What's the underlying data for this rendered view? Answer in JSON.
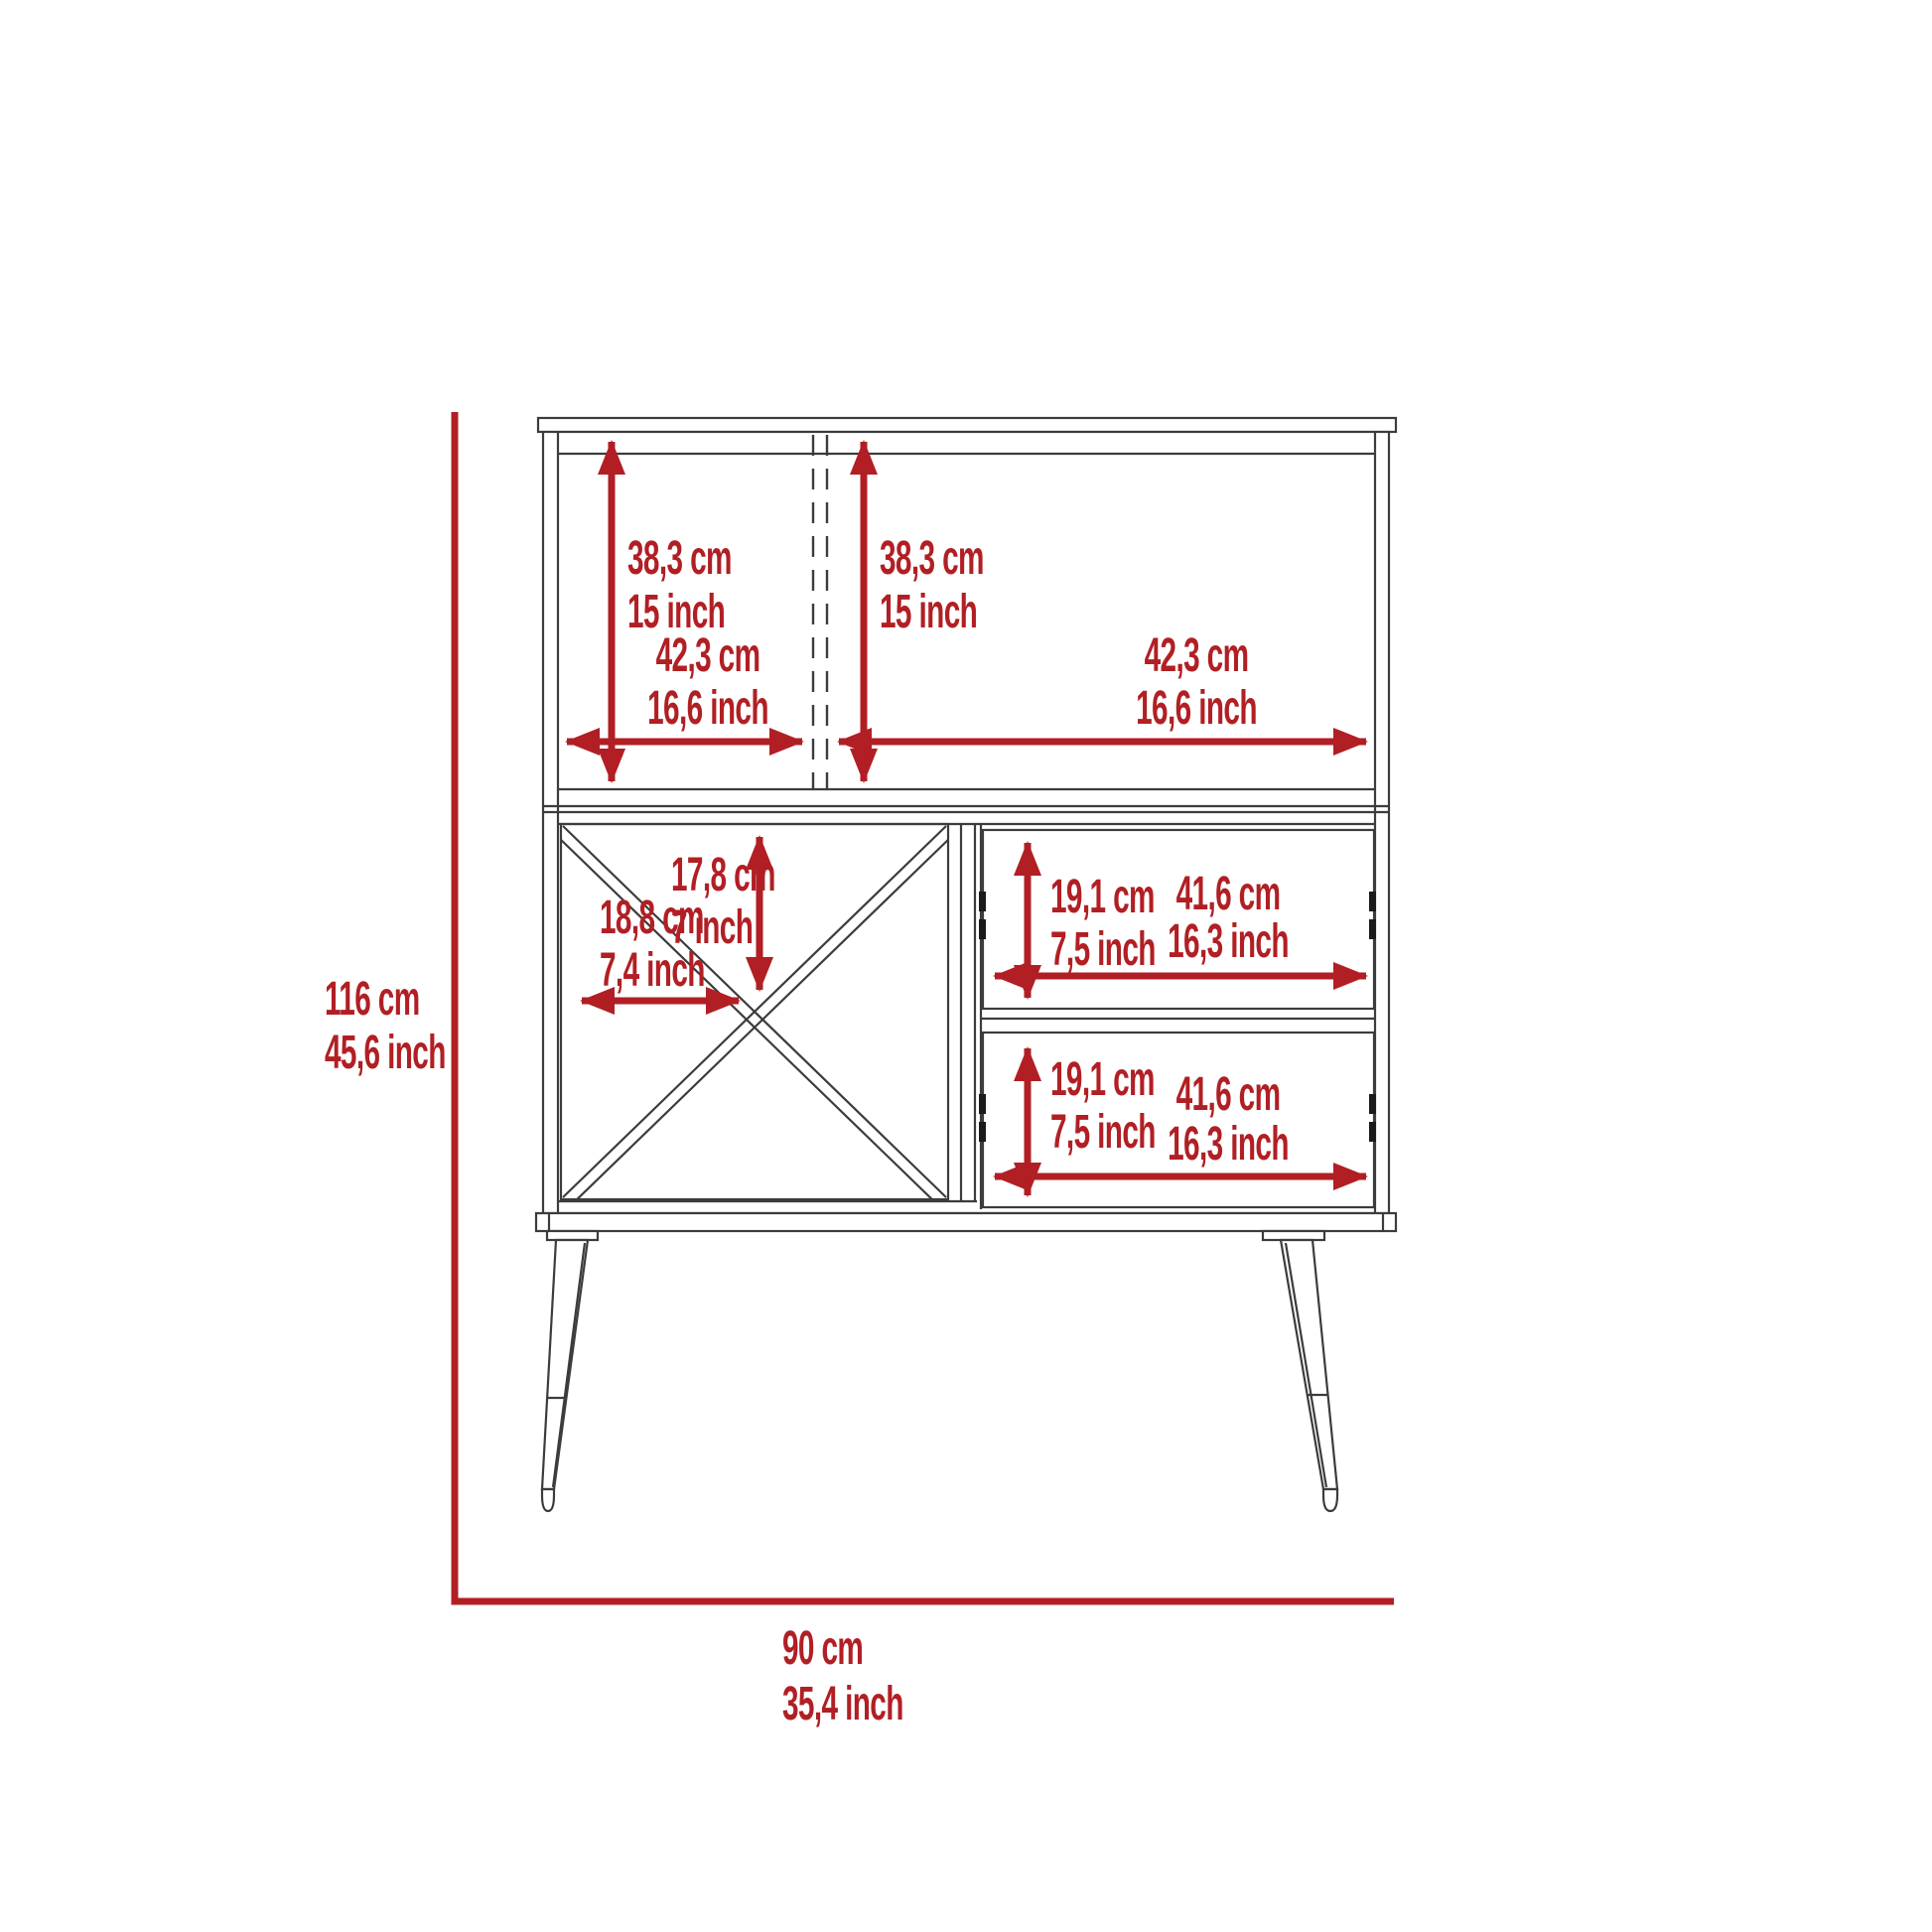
{
  "diagram": {
    "type": "furniture-dimension-drawing",
    "subject": "bar cabinet front elevation with legs, two top doors, X wine rack and two drawers",
    "colors": {
      "dimension_red": "#b11f24",
      "line_color": "#3c3c3c",
      "background": "#ffffff",
      "hinge_black": "#1a1a1a"
    },
    "overall": {
      "height_cm": "116 cm",
      "height_inch": "45,6 inch",
      "width_cm": "90 cm",
      "width_inch": "35,4 inch"
    },
    "top_left_door": {
      "height_cm": "38,3 cm",
      "height_inch": "15 inch",
      "width_cm": "42,3 cm",
      "width_inch": "16,6 inch"
    },
    "top_right_door": {
      "height_cm": "38,3 cm",
      "height_inch": "15 inch",
      "width_cm": "42,3 cm",
      "width_inch": "16,6 inch"
    },
    "wine_rack": {
      "width_cm": "18,8 cm",
      "width_inch": "7,4 inch",
      "height_cm": "17,8 cm",
      "height_inch": "7 inch"
    },
    "upper_drawer": {
      "height_cm": "19,1 cm",
      "height_inch": "7,5 inch",
      "width_cm": "41,6 cm",
      "width_inch": "16,3 inch"
    },
    "lower_drawer": {
      "height_cm": "19,1 cm",
      "height_inch": "7,5 inch",
      "width_cm": "41,6 cm",
      "width_inch": "16,3 inch"
    }
  }
}
